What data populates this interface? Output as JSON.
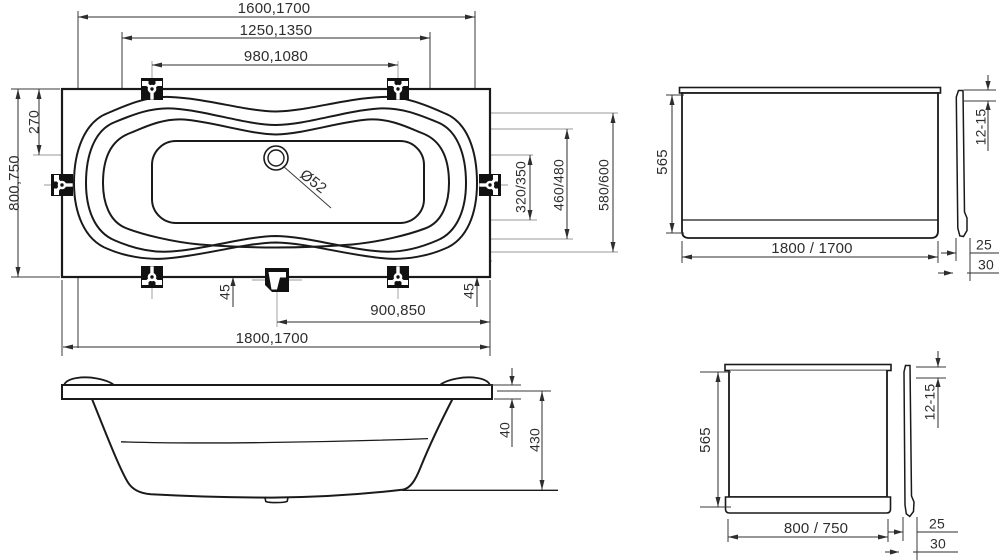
{
  "plan": {
    "len_top": "1600,1700",
    "len_mid": "1250,1350",
    "len_inner": "980,1080",
    "width_overall": "800,750",
    "waterline_offset": "270",
    "width_inner": "320/350",
    "width_mid": "460/480",
    "width_end": "580/600",
    "support_left": "45",
    "support_right": "45",
    "drain_to_end": "900,850",
    "len_overall": "1800,1700",
    "drain_diameter": "Ø52"
  },
  "side_view": {
    "rim_height": "40",
    "depth": "430"
  },
  "front_panel": {
    "height": "565",
    "width": "1800 / 1700",
    "top_inset": "12-15",
    "foot_inset_a": "25",
    "foot_inset_b": "30"
  },
  "end_panel": {
    "height": "565",
    "width": "800 / 750",
    "top_inset": "12-15",
    "foot_inset_a": "25",
    "foot_inset_b": "30"
  },
  "palette": {
    "line": "#1a1a1a",
    "dim": "#2e2e2e",
    "reference": "#9a9a9a",
    "background": "#ffffff"
  }
}
